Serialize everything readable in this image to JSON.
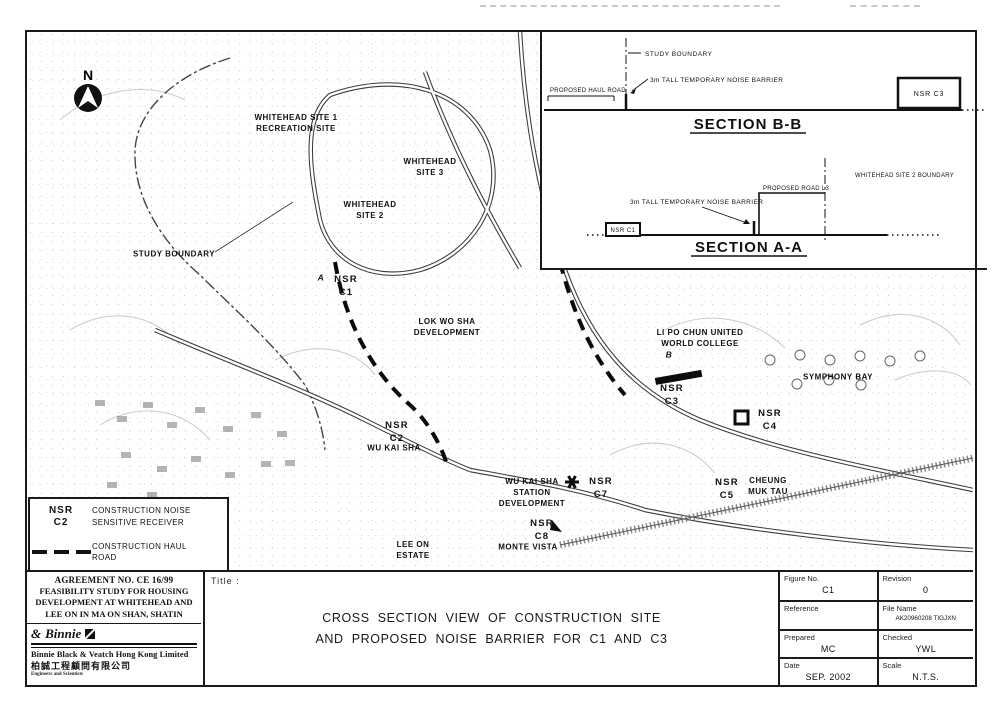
{
  "inset": {
    "section_bb": {
      "title": "SECTION B-B",
      "study_boundary_label": "STUDY BOUNDARY",
      "haul_road_label": "PROPOSED HAUL ROAD",
      "barrier_label": "3m TALL TEMPORARY NOISE BARRIER",
      "nsr_box_label": "NSR C3"
    },
    "section_aa": {
      "title": "SECTION A-A",
      "barrier_label": "3m TALL TEMPORARY NOISE BARRIER",
      "road_label": "PROPOSED ROAD L3",
      "boundary_label": "WHITEHEAD SITE 2 BOUNDARY",
      "nsr_box_label": "NSR C1"
    }
  },
  "map": {
    "north_label": "N",
    "labels": [
      {
        "id": "whitehead-site-1",
        "text": "WHITEHEAD SITE 1\nRECREATION SITE"
      },
      {
        "id": "whitehead-site-3",
        "text": "WHITEHEAD\nSITE 3"
      },
      {
        "id": "whitehead-site-2",
        "text": "WHITEHEAD\nSITE 2"
      },
      {
        "id": "study-boundary",
        "text": "STUDY BOUNDARY"
      },
      {
        "id": "nsr-c1",
        "text": "NSR\nC1"
      },
      {
        "id": "section-marker-a",
        "text": "A"
      },
      {
        "id": "lok-wo-sha",
        "text": "LOK WO SHA\nDEVELOPMENT"
      },
      {
        "id": "li-po-chun",
        "text": "LI PO CHUN UNITED\nWORLD COLLEGE"
      },
      {
        "id": "section-marker-b",
        "text": "B"
      },
      {
        "id": "nsr-c3",
        "text": "NSR\nC3"
      },
      {
        "id": "symphony-bay",
        "text": "SYMPHONY BAY"
      },
      {
        "id": "nsr-c4",
        "text": "NSR\nC4"
      },
      {
        "id": "nsr-c2",
        "text": "NSR\nC2"
      },
      {
        "id": "wu-kai-sha",
        "text": "WU KAI SHA"
      },
      {
        "id": "wu-kai-sha-station",
        "text": "WU KAI SHA\nSTATION\nDEVELOPMENT"
      },
      {
        "id": "nsr-c7",
        "text": "NSR\nC7"
      },
      {
        "id": "nsr-c5",
        "text": "NSR\nC5"
      },
      {
        "id": "cheung-muk-tau",
        "text": "CHEUNG\nMUK TAU"
      },
      {
        "id": "nsr-c8",
        "text": "NSR\nC8"
      },
      {
        "id": "lee-on-estate",
        "text": "LEE ON\nESTATE"
      },
      {
        "id": "monte-vista",
        "text": "MONTE VISTA"
      }
    ]
  },
  "legend": {
    "nsr_symbol": "NSR\nC2",
    "nsr_text": "CONSTRUCTION NOISE\nSENSITIVE RECEIVER",
    "haul_text": "CONSTRUCTION HAUL\nROAD"
  },
  "title_block": {
    "agreement": "AGREEMENT NO. CE 16/99",
    "project_lines": "FEASIBILITY STUDY FOR HOUSING\nDEVELOPMENT AT WHITEHEAD AND\nLEE ON IN MA ON SHAN, SHATIN",
    "firm_logo_amp": "&",
    "firm_logo_text": "Binnie",
    "firm_name": "Binnie Black & Veatch Hong Kong Limited",
    "firm_name_chinese": "柏誠工程顧問有限公司",
    "firm_tagline": "Engineers and Scientists",
    "title_label": "Title :",
    "title": "CROSS SECTION VIEW OF CONSTRUCTION SITE\nAND PROPOSED NOISE BARRIER FOR C1 AND C3",
    "fields": {
      "figure_no_label": "Figure No.",
      "figure_no": "C1",
      "revision_label": "Revision",
      "revision": "0",
      "reference_label": "Reference",
      "reference": "",
      "file_name_label": "File Name",
      "file_name": "AK20960208 TIGJXN",
      "prepared_label": "Prepared",
      "prepared": "MC",
      "checked_label": "Checked",
      "checked": "YWL",
      "date_label": "Date",
      "date": "SEP. 2002",
      "scale_label": "Scale",
      "scale": "N.T.S."
    }
  },
  "colors": {
    "ink": "#1a1a1a"
  }
}
